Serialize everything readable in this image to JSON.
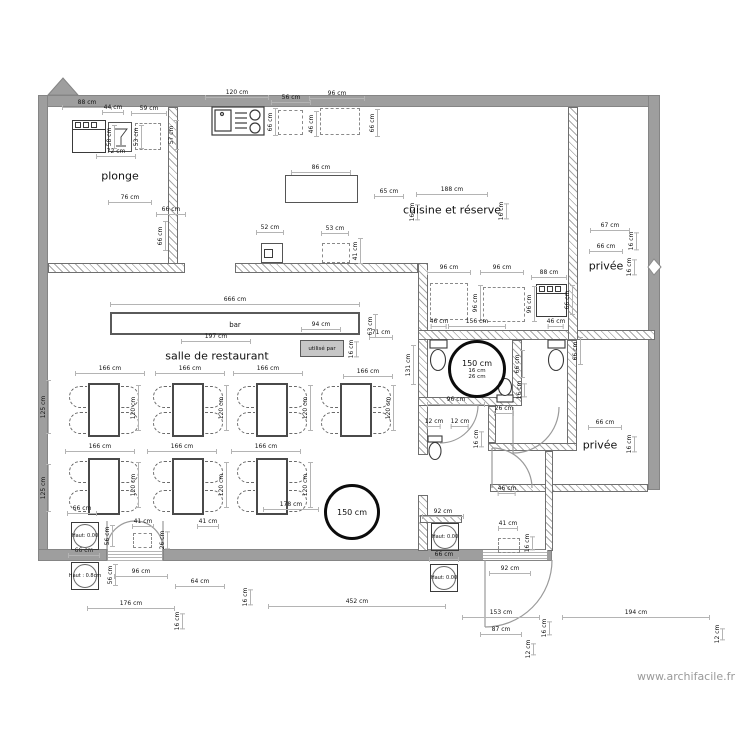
{
  "watermark": "www.archifacile.fr",
  "chip": {
    "label": "utilisé par"
  },
  "rooms": [
    {
      "label": "plonge",
      "x": 120,
      "y": 176
    },
    {
      "label": "cuisine et réserve",
      "x": 452,
      "y": 210
    },
    {
      "label": "salle de restaurant",
      "x": 217,
      "y": 356
    },
    {
      "label": "privée",
      "x": 606,
      "y": 266
    },
    {
      "label": "privée",
      "x": 600,
      "y": 445
    },
    {
      "label": "bar",
      "x": 235,
      "y": 325,
      "small": 1
    }
  ],
  "markers": [
    {
      "label": "Haut: 0.00",
      "x": 85,
      "y": 536
    },
    {
      "label": "Haut : 0.8cm",
      "x": 85,
      "y": 576
    },
    {
      "label": "Haut: 0.00",
      "x": 445,
      "y": 537
    },
    {
      "label": "Haut: 0.00",
      "x": 444,
      "y": 578
    }
  ],
  "circles": [
    {
      "label": "150 cm",
      "cx": 352,
      "cy": 512,
      "r": 28,
      "subs": []
    },
    {
      "label": "150 cm",
      "cx": 477,
      "cy": 369,
      "r": 29,
      "subs": [
        "16 cm",
        "26 cm"
      ]
    }
  ],
  "dimensions": [
    {
      "t": "88 cm",
      "x": 87,
      "y": 104,
      "w": 50
    },
    {
      "t": "44 cm",
      "x": 113,
      "y": 109,
      "w": 22
    },
    {
      "t": "59 cm",
      "x": 149,
      "y": 110,
      "w": 36
    },
    {
      "t": "57 cm",
      "x": 173,
      "y": 135,
      "w": 30,
      "v": 1
    },
    {
      "t": "58 cm",
      "x": 111,
      "y": 137,
      "w": 24,
      "v": 1
    },
    {
      "t": "53 cm",
      "x": 138,
      "y": 137,
      "w": 24,
      "v": 1
    },
    {
      "t": "72 cm",
      "x": 116,
      "y": 153,
      "w": 40
    },
    {
      "t": "76 cm",
      "x": 130,
      "y": 199,
      "w": 44
    },
    {
      "t": "66 cm",
      "x": 171,
      "y": 211,
      "w": 30
    },
    {
      "t": "66 cm",
      "x": 162,
      "y": 236,
      "w": 30,
      "v": 1
    },
    {
      "t": "120 cm",
      "x": 237,
      "y": 94,
      "w": 64
    },
    {
      "t": "56 cm",
      "x": 291,
      "y": 99,
      "w": 40
    },
    {
      "t": "96 cm",
      "x": 337,
      "y": 95,
      "w": 56
    },
    {
      "t": "66 cm",
      "x": 272,
      "y": 122,
      "w": 28,
      "v": 1
    },
    {
      "t": "46 cm",
      "x": 313,
      "y": 124,
      "w": 26,
      "v": 1
    },
    {
      "t": "66 cm",
      "x": 374,
      "y": 123,
      "w": 28,
      "v": 1
    },
    {
      "t": "86 cm",
      "x": 321,
      "y": 169,
      "w": 60
    },
    {
      "t": "65 cm",
      "x": 389,
      "y": 193,
      "w": 30
    },
    {
      "t": "188 cm",
      "x": 452,
      "y": 191,
      "w": 72
    },
    {
      "t": "16 cm",
      "x": 414,
      "y": 212,
      "w": 16,
      "v": 1
    },
    {
      "t": "16 cm",
      "x": 503,
      "y": 211,
      "w": 16,
      "v": 1
    },
    {
      "t": "41 cm",
      "x": 357,
      "y": 251,
      "w": 26,
      "v": 1
    },
    {
      "t": "52 cm",
      "x": 270,
      "y": 229,
      "w": 28
    },
    {
      "t": "53 cm",
      "x": 335,
      "y": 230,
      "w": 28
    },
    {
      "t": "96 cm",
      "x": 449,
      "y": 269,
      "w": 44
    },
    {
      "t": "96 cm",
      "x": 502,
      "y": 269,
      "w": 44
    },
    {
      "t": "88 cm",
      "x": 549,
      "y": 274,
      "w": 36
    },
    {
      "t": "96 cm",
      "x": 477,
      "y": 303,
      "w": 36,
      "v": 1
    },
    {
      "t": "96 cm",
      "x": 531,
      "y": 304,
      "w": 36,
      "v": 1
    },
    {
      "t": "66 cm",
      "x": 569,
      "y": 300,
      "w": 30,
      "v": 1
    },
    {
      "t": "46 cm",
      "x": 439,
      "y": 323,
      "w": 16
    },
    {
      "t": "156 cm",
      "x": 477,
      "y": 323,
      "w": 58
    },
    {
      "t": "46 cm",
      "x": 556,
      "y": 323,
      "w": 16
    },
    {
      "t": "67 cm",
      "x": 610,
      "y": 227,
      "w": 40
    },
    {
      "t": "16 cm",
      "x": 633,
      "y": 241,
      "w": 18,
      "v": 1
    },
    {
      "t": "66 cm",
      "x": 606,
      "y": 248,
      "w": 34
    },
    {
      "t": "16 cm",
      "x": 631,
      "y": 267,
      "w": 16,
      "v": 1
    },
    {
      "t": "666 cm",
      "x": 235,
      "y": 301,
      "w": 250
    },
    {
      "t": "197 cm",
      "x": 216,
      "y": 338,
      "w": 70
    },
    {
      "t": "94 cm",
      "x": 321,
      "y": 326,
      "w": 40
    },
    {
      "t": "16 cm",
      "x": 353,
      "y": 349,
      "w": 16,
      "v": 1
    },
    {
      "t": "63 cm",
      "x": 372,
      "y": 326,
      "w": 24,
      "v": 1
    },
    {
      "t": "71 cm",
      "x": 381,
      "y": 334,
      "w": 24
    },
    {
      "t": "131 cm",
      "x": 410,
      "y": 365,
      "w": 40,
      "v": 1
    },
    {
      "t": "166 cm",
      "x": 368,
      "y": 373,
      "w": 50
    },
    {
      "t": "166 cm",
      "x": 110,
      "y": 370,
      "w": 70
    },
    {
      "t": "166 cm",
      "x": 190,
      "y": 370,
      "w": 70
    },
    {
      "t": "166 cm",
      "x": 268,
      "y": 370,
      "w": 70
    },
    {
      "t": "120 cm",
      "x": 135,
      "y": 408,
      "w": 46,
      "v": 1
    },
    {
      "t": "120 cm",
      "x": 223,
      "y": 408,
      "w": 46,
      "v": 1
    },
    {
      "t": "120 cm",
      "x": 307,
      "y": 408,
      "w": 46,
      "v": 1
    },
    {
      "t": "120 cm",
      "x": 390,
      "y": 408,
      "w": 46,
      "v": 1
    },
    {
      "t": "166 cm",
      "x": 100,
      "y": 448,
      "w": 70
    },
    {
      "t": "166 cm",
      "x": 182,
      "y": 448,
      "w": 70
    },
    {
      "t": "166 cm",
      "x": 266,
      "y": 448,
      "w": 70
    },
    {
      "t": "120 cm",
      "x": 135,
      "y": 485,
      "w": 46,
      "v": 1
    },
    {
      "t": "120 cm",
      "x": 223,
      "y": 485,
      "w": 46,
      "v": 1
    },
    {
      "t": "120 cm",
      "x": 307,
      "y": 485,
      "w": 46,
      "v": 1
    },
    {
      "t": "178 cm",
      "x": 291,
      "y": 506,
      "w": 56
    },
    {
      "t": "66 cm",
      "x": 82,
      "y": 510,
      "w": 30
    },
    {
      "t": "125 cm",
      "x": 45,
      "y": 407,
      "w": 54,
      "v": 1
    },
    {
      "t": "125 cm",
      "x": 45,
      "y": 488,
      "w": 48,
      "v": 1
    },
    {
      "t": "41 cm",
      "x": 143,
      "y": 523,
      "w": 22
    },
    {
      "t": "41 cm",
      "x": 208,
      "y": 523,
      "w": 22
    },
    {
      "t": "56 cm",
      "x": 109,
      "y": 536,
      "w": 22,
      "v": 1
    },
    {
      "t": "66 cm",
      "x": 84,
      "y": 552,
      "w": 32
    },
    {
      "t": "26 cm",
      "x": 164,
      "y": 540,
      "w": 18,
      "v": 1
    },
    {
      "t": "56 cm",
      "x": 112,
      "y": 575,
      "w": 22,
      "v": 1
    },
    {
      "t": "96 cm",
      "x": 141,
      "y": 573,
      "w": 54
    },
    {
      "t": "64 cm",
      "x": 200,
      "y": 583,
      "w": 50
    },
    {
      "t": "16 cm",
      "x": 247,
      "y": 597,
      "w": 16,
      "v": 1
    },
    {
      "t": "176 cm",
      "x": 131,
      "y": 605,
      "w": 88
    },
    {
      "t": "16 cm",
      "x": 179,
      "y": 621,
      "w": 16,
      "v": 1
    },
    {
      "t": "452 cm",
      "x": 357,
      "y": 603,
      "w": 178
    },
    {
      "t": "96 cm",
      "x": 456,
      "y": 401,
      "w": 58
    },
    {
      "t": "12 cm",
      "x": 434,
      "y": 423,
      "w": 14
    },
    {
      "t": "12 cm",
      "x": 460,
      "y": 423,
      "w": 18
    },
    {
      "t": "16 cm",
      "x": 478,
      "y": 439,
      "w": 16,
      "v": 1
    },
    {
      "t": "26 cm",
      "x": 504,
      "y": 410,
      "w": 20
    },
    {
      "t": "66 cm",
      "x": 519,
      "y": 364,
      "w": 28,
      "v": 1
    },
    {
      "t": "16 cm",
      "x": 521,
      "y": 390,
      "w": 14,
      "v": 1
    },
    {
      "t": "66 cm",
      "x": 577,
      "y": 351,
      "w": 28,
      "v": 1
    },
    {
      "t": "46 cm",
      "x": 507,
      "y": 490,
      "w": 18
    },
    {
      "t": "92 cm",
      "x": 443,
      "y": 513,
      "w": 42
    },
    {
      "t": "41 cm",
      "x": 508,
      "y": 525,
      "w": 20
    },
    {
      "t": "16 cm",
      "x": 529,
      "y": 543,
      "w": 14,
      "v": 1
    },
    {
      "t": "66 cm",
      "x": 444,
      "y": 556,
      "w": 30
    },
    {
      "t": "92 cm",
      "x": 510,
      "y": 570,
      "w": 42
    },
    {
      "t": "66 cm",
      "x": 605,
      "y": 424,
      "w": 34
    },
    {
      "t": "16 cm",
      "x": 631,
      "y": 444,
      "w": 16,
      "v": 1
    },
    {
      "t": "153 cm",
      "x": 501,
      "y": 614,
      "w": 78
    },
    {
      "t": "16 cm",
      "x": 546,
      "y": 628,
      "w": 14,
      "v": 1
    },
    {
      "t": "87 cm",
      "x": 501,
      "y": 631,
      "w": 42
    },
    {
      "t": "12 cm",
      "x": 530,
      "y": 649,
      "w": 12,
      "v": 1
    },
    {
      "t": "194 cm",
      "x": 636,
      "y": 614,
      "w": 148
    },
    {
      "t": "12 cm",
      "x": 719,
      "y": 634,
      "w": 12,
      "v": 1
    }
  ]
}
